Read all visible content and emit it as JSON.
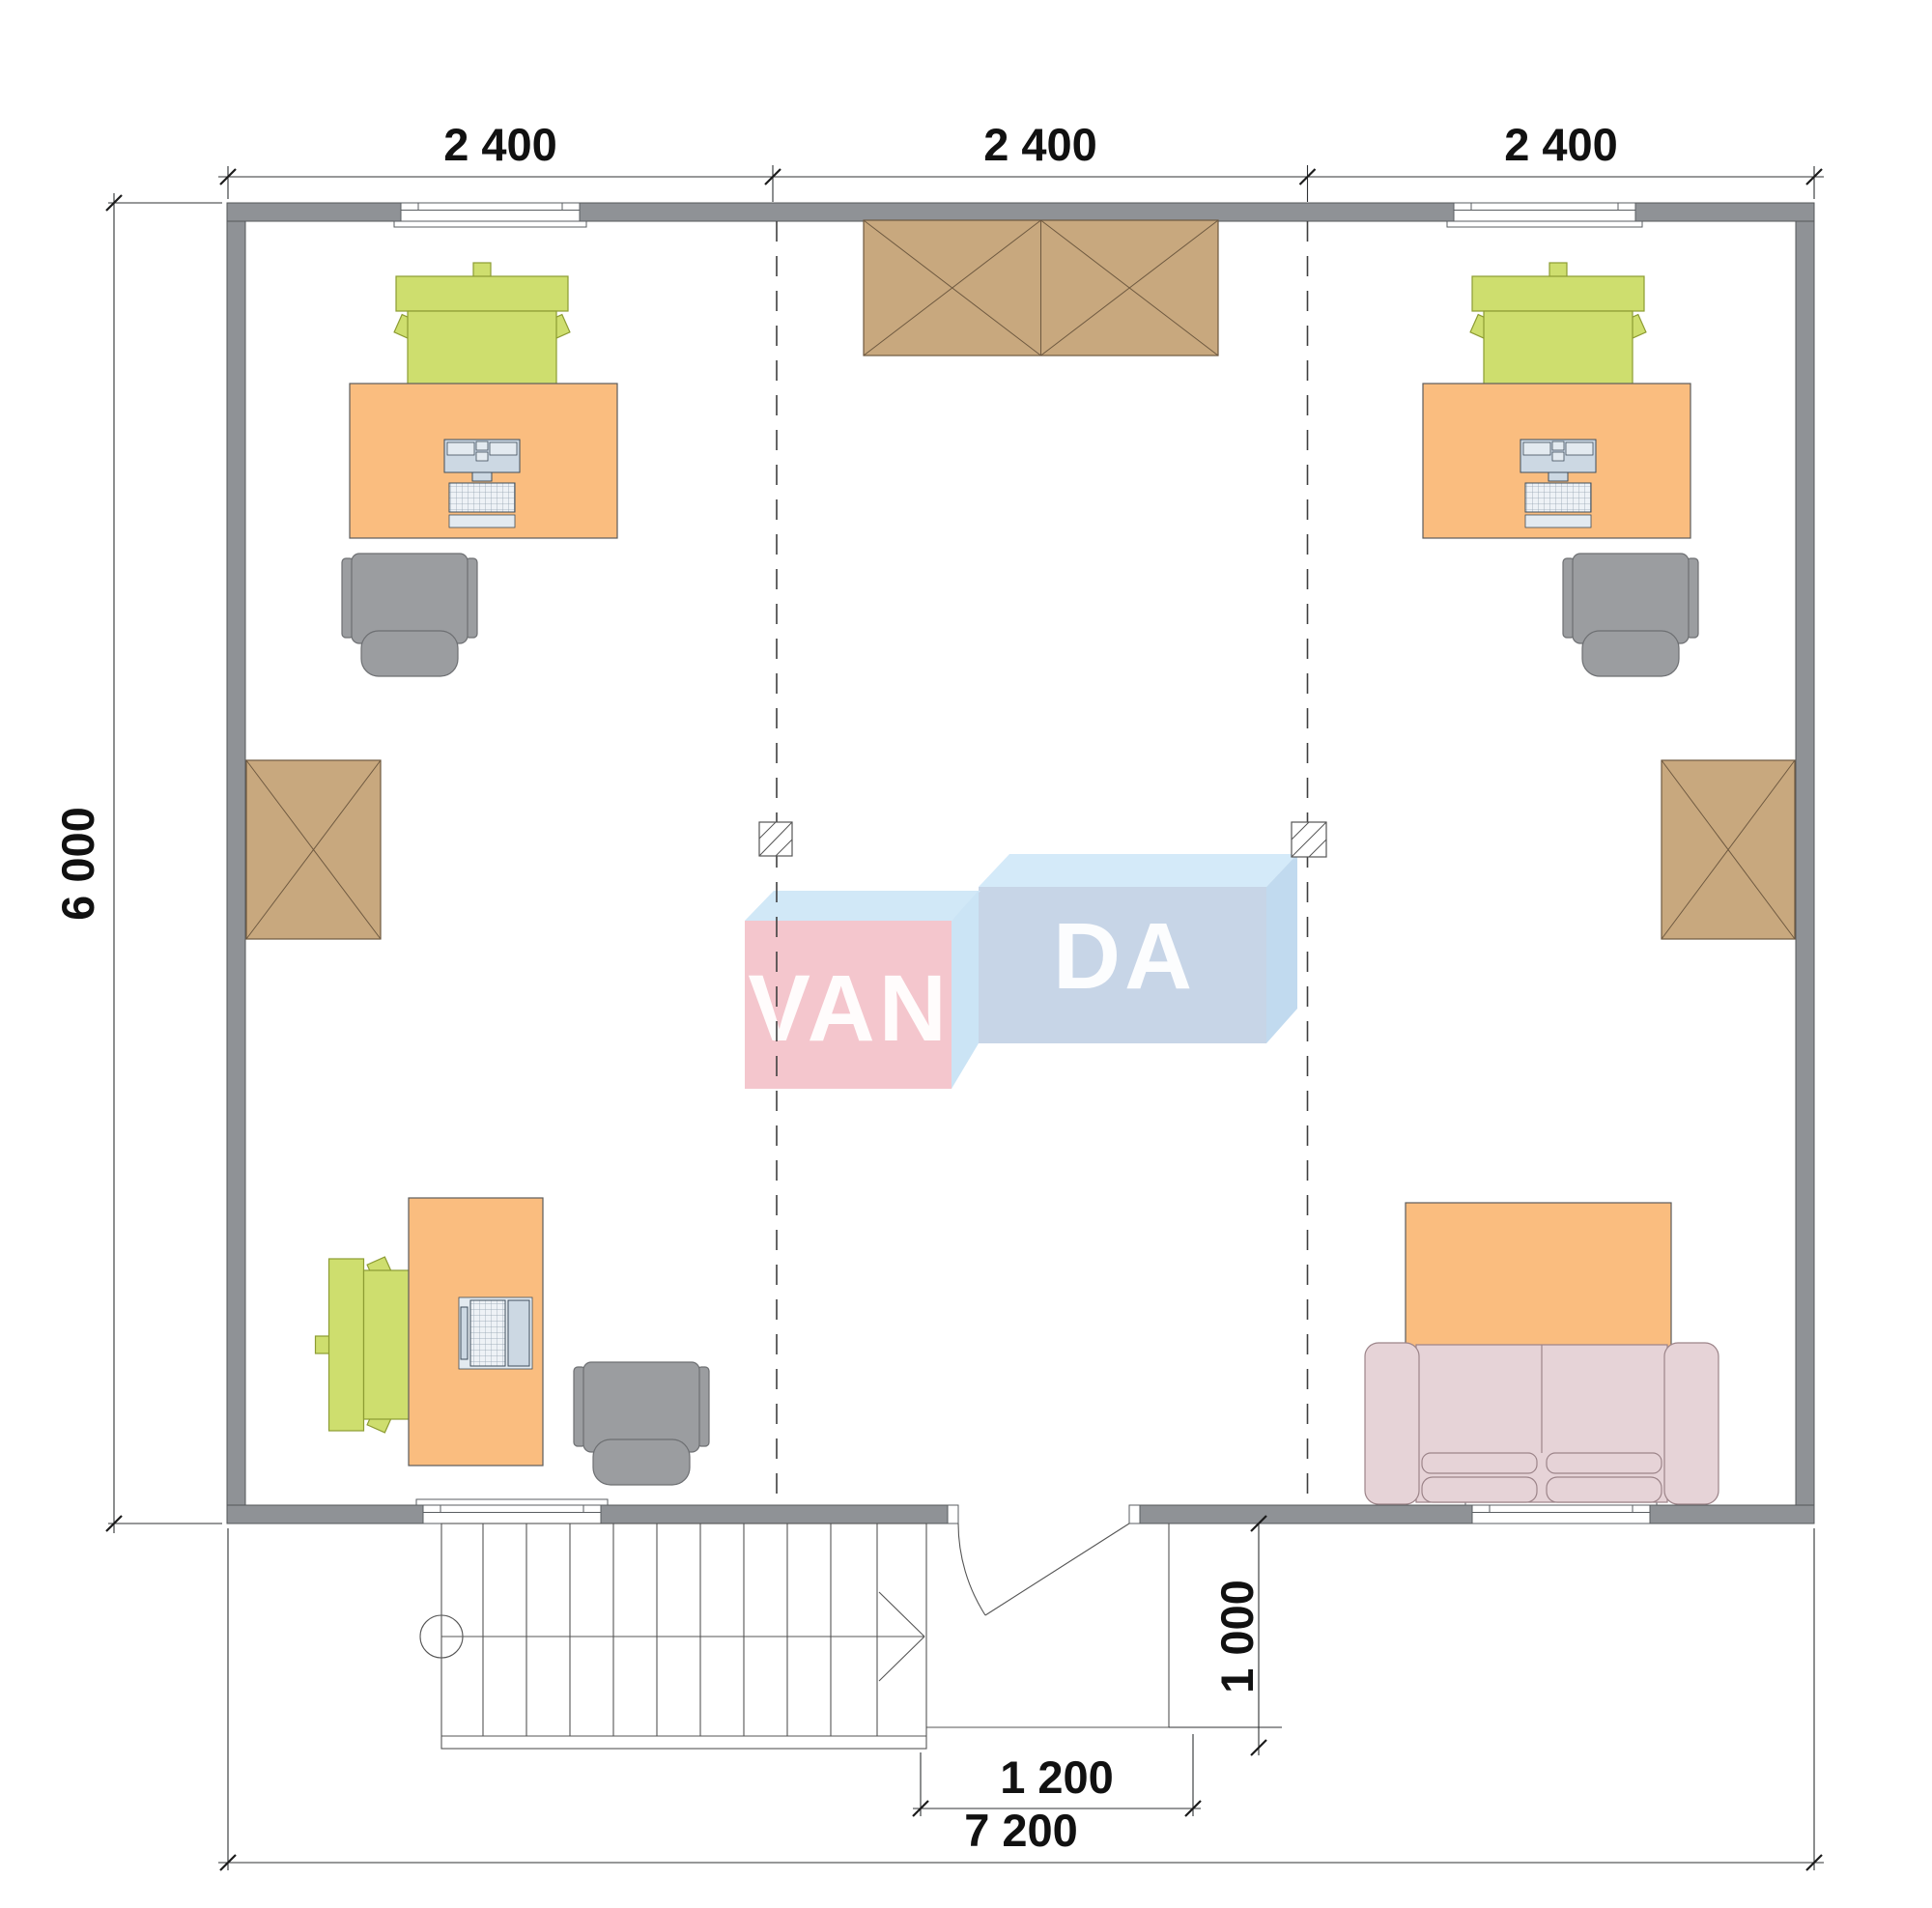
{
  "drawing": {
    "type": "architectural-floor-plan",
    "dimensions": {
      "top": [
        "2 400",
        "2 400",
        "2 400"
      ],
      "left": "6 000",
      "bottom_total": "7 200",
      "entry_width": "1 200",
      "entry_depth": "1 000"
    },
    "watermark": {
      "left": "VAN",
      "right": "DA",
      "full": "VANDA"
    },
    "colors": {
      "wall": "#8f9296",
      "wardrobe": "#c8a87e",
      "desk": "#fabd7f",
      "chair_green": "#cede6e",
      "chair_gray": "#9b9da0",
      "sofa": "#e6d3d7",
      "logo_pink": "#f4c4cb",
      "logo_light_blue": "#cfe7f7",
      "logo_slate_blue": "#c5d3e6"
    },
    "furniture": [
      "office-desk-top-left",
      "office-desk-top-right",
      "office-desk-bottom-left",
      "desktop-computer",
      "desktop-computer",
      "laptop",
      "green-office-chair",
      "green-office-chair",
      "green-office-chair",
      "gray-task-chair",
      "gray-task-chair",
      "gray-task-chair",
      "wardrobe-top",
      "wardrobe-left",
      "wardrobe-right",
      "sofa",
      "coffee-table",
      "stairs",
      "entry-door",
      "columns"
    ]
  }
}
